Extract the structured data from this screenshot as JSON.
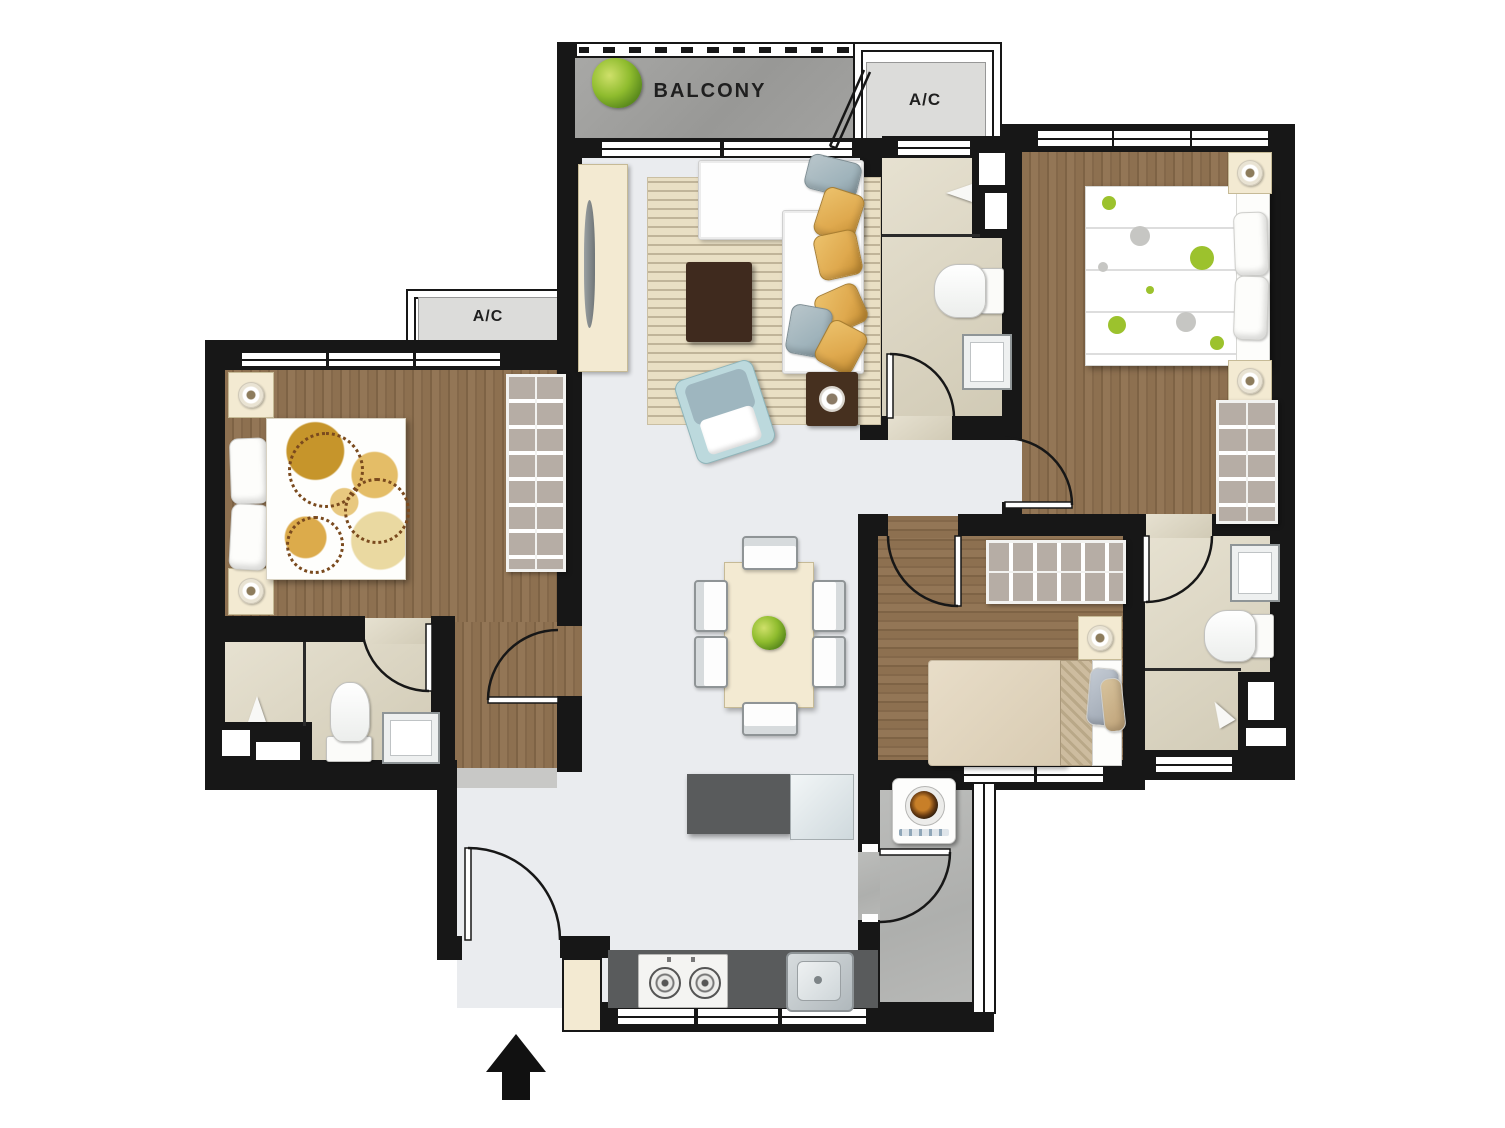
{
  "labels": {
    "balcony": "BALCONY",
    "ac_top": "A/C",
    "ac_left": "A/C"
  },
  "colors": {
    "wall": "#171717",
    "floor-light": "#eaecef",
    "floor-bath": "#ded7c1",
    "ac-ledge": "#dcdcda",
    "cream": "#f3ead2",
    "dark-brown": "#3f2a1e",
    "counter": "#595b5c",
    "gold": "#dfa94e",
    "gray-blue": "#9fb3bb",
    "armchair": "#bcd9dd",
    "green-accent": "#8db32a",
    "wardrobe": "#b6ada5"
  },
  "objects": [
    "balcony-plant",
    "l-shaped-sofa",
    "coffee-table",
    "armchair",
    "tv-console",
    "striped-rug",
    "side-table",
    "dining-table",
    "dining-chairs-x6",
    "dining-plant",
    "double-bed-master",
    "double-bed-left",
    "single-bed",
    "wardrobe-x3",
    "nightstand-with-lamp-x5",
    "toilet-x3",
    "sink-x3",
    "shower-x3",
    "washing-machine",
    "kitchen-counter",
    "gas-stove",
    "kitchen-sink",
    "kitchen-island",
    "entrance-arrow",
    "doors-x8",
    "folding-balcony-door",
    "ac-ledge-x2"
  ]
}
